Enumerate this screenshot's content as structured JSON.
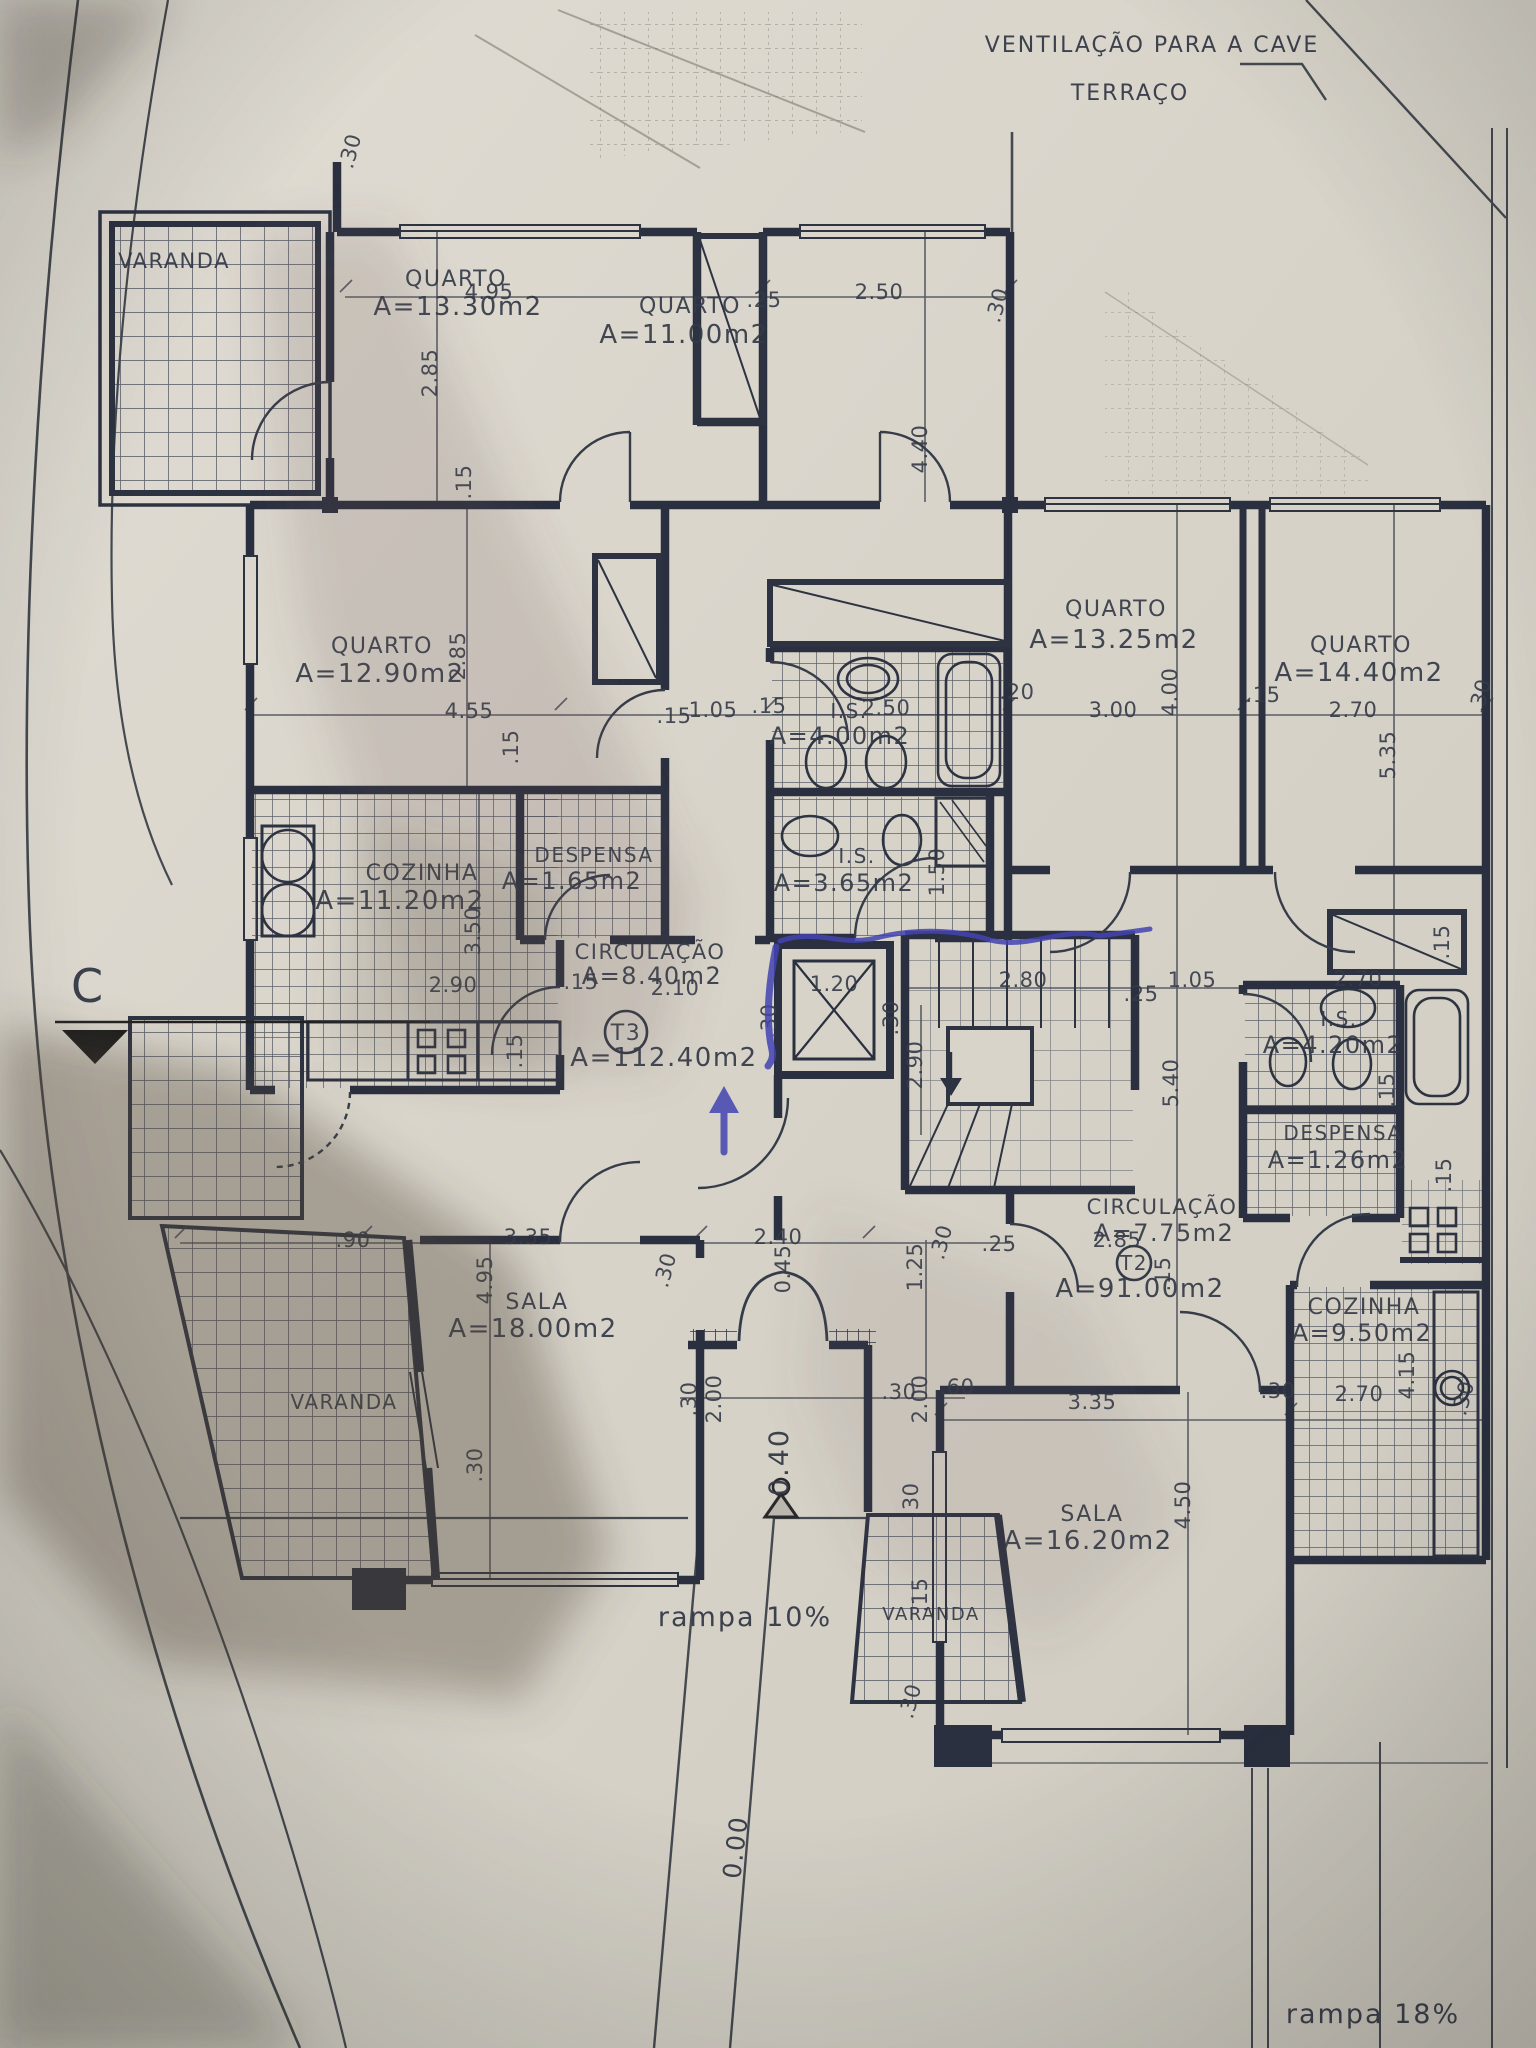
{
  "document_kind": "architectural floor plan photo",
  "colors": {
    "paper": "#d8d4ca",
    "ink": "#2e3342",
    "thin_line": "#454a56",
    "pen_blue": "#4343b2",
    "marker_black": "#1d1d1d"
  },
  "annotations": {
    "site": [
      {
        "name": "label-ventilacao-cave",
        "text": "VENTILAÇÃO PARA A CAVE",
        "x": 1152,
        "y": 52,
        "s": 22
      },
      {
        "name": "label-terraco",
        "text": "TERRAÇO",
        "x": 1130,
        "y": 100,
        "s": 22
      },
      {
        "name": "label-rampa-10",
        "text": "rampa 10%",
        "x": 745,
        "y": 1626,
        "s": 27
      },
      {
        "name": "label-rampa-18",
        "text": "rampa 18%",
        "x": 1373,
        "y": 2023,
        "s": 27
      },
      {
        "name": "level-mark-0-00",
        "text": "0.00",
        "x": 744,
        "y": 1848,
        "r": -83,
        "s": 25
      },
      {
        "name": "level-mark-0-40",
        "text": "0.40",
        "x": 788,
        "y": 1462,
        "r": -90,
        "s": 27
      },
      {
        "name": "section-marker-c",
        "text": "C",
        "x": 88,
        "y": 1002,
        "s": 46
      }
    ],
    "rooms": [
      {
        "name": "room-varanda-topleft",
        "text": "VARANDA",
        "x": 174,
        "y": 268,
        "s": 21
      },
      {
        "name": "room-quarto1",
        "text": "QUARTO",
        "x": 456,
        "y": 286,
        "s": 22
      },
      {
        "name": "room-quarto1-area",
        "text": "A=13.30m2",
        "x": 458,
        "y": 315,
        "s": 26
      },
      {
        "name": "room-quarto2",
        "text": "QUARTO",
        "x": 690,
        "y": 313,
        "s": 22
      },
      {
        "name": "room-quarto2-area",
        "text": "A=11.00m2",
        "x": 684,
        "y": 343,
        "s": 26
      },
      {
        "name": "room-quarto3",
        "text": "QUARTO",
        "x": 382,
        "y": 653,
        "s": 22
      },
      {
        "name": "room-quarto3-area",
        "text": "A=12.90m2",
        "x": 380,
        "y": 682,
        "s": 26
      },
      {
        "name": "room-cozinha-t3",
        "text": "COZINHA",
        "x": 422,
        "y": 880,
        "s": 22
      },
      {
        "name": "room-cozinha-t3-area",
        "text": "A=11.20m2",
        "x": 400,
        "y": 909,
        "s": 26
      },
      {
        "name": "room-despensa-t3",
        "text": "DESPENSA",
        "x": 594,
        "y": 862,
        "s": 20
      },
      {
        "name": "room-despensa-t3-area",
        "text": "A=1.65m2",
        "x": 572,
        "y": 889,
        "s": 24
      },
      {
        "name": "room-circulacao-t3",
        "text": "CIRCULAÇÃO",
        "x": 650,
        "y": 959,
        "s": 21
      },
      {
        "name": "room-circulacao-t3-area",
        "text": "A=8.40m2",
        "x": 652,
        "y": 984,
        "s": 24
      },
      {
        "name": "unit-t3",
        "text": "T3",
        "x": 626,
        "y": 1040,
        "s": 22
      },
      {
        "name": "unit-t3-area",
        "text": "A=112.40m2",
        "x": 664,
        "y": 1066,
        "s": 26
      },
      {
        "name": "room-is-400",
        "text": "I.S.",
        "x": 849,
        "y": 718,
        "s": 20
      },
      {
        "name": "room-is-400-area",
        "text": "A=4.00m2",
        "x": 840,
        "y": 744,
        "s": 24
      },
      {
        "name": "room-is-365",
        "text": "I.S.",
        "x": 857,
        "y": 863,
        "s": 20
      },
      {
        "name": "room-is-365-area",
        "text": "A=3.65m2",
        "x": 844,
        "y": 891,
        "s": 24
      },
      {
        "name": "room-sala-t3",
        "text": "SALA",
        "x": 537,
        "y": 1309,
        "s": 22
      },
      {
        "name": "room-sala-t3-area",
        "text": "A=18.00m2",
        "x": 533,
        "y": 1337,
        "s": 26
      },
      {
        "name": "room-varanda-left",
        "text": "VARANDA",
        "x": 344,
        "y": 1409,
        "s": 20
      },
      {
        "name": "room-quarto4",
        "text": "QUARTO",
        "x": 1116,
        "y": 616,
        "s": 22
      },
      {
        "name": "room-quarto4-area",
        "text": "A=13.25m2",
        "x": 1114,
        "y": 648,
        "s": 26
      },
      {
        "name": "room-quarto5",
        "text": "QUARTO",
        "x": 1361,
        "y": 652,
        "s": 22
      },
      {
        "name": "room-quarto5-area",
        "text": "A=14.40m2",
        "x": 1359,
        "y": 681,
        "s": 26
      },
      {
        "name": "room-is-420",
        "text": "I.S.",
        "x": 1339,
        "y": 1026,
        "s": 20
      },
      {
        "name": "room-is-420-area",
        "text": "A=4.20m2",
        "x": 1333,
        "y": 1053,
        "s": 24
      },
      {
        "name": "room-despensa-t2",
        "text": "DESPENSA",
        "x": 1343,
        "y": 1140,
        "s": 20
      },
      {
        "name": "room-despensa-t2-area",
        "text": "A=1.26m2",
        "x": 1338,
        "y": 1168,
        "s": 24
      },
      {
        "name": "room-circulacao-t2",
        "text": "CIRCULAÇÃO",
        "x": 1162,
        "y": 1214,
        "s": 21
      },
      {
        "name": "room-circulacao-t2-area",
        "text": "A=7.75m2",
        "x": 1164,
        "y": 1241,
        "s": 24
      },
      {
        "name": "unit-t2",
        "text": "T2",
        "x": 1134,
        "y": 1270,
        "s": 20
      },
      {
        "name": "unit-t2-area",
        "text": "A=91.00m2",
        "x": 1140,
        "y": 1297,
        "s": 26
      },
      {
        "name": "room-cozinha-t2",
        "text": "COZINHA",
        "x": 1364,
        "y": 1314,
        "s": 22
      },
      {
        "name": "room-cozinha-t2-area",
        "text": "A=9.50m2",
        "x": 1362,
        "y": 1341,
        "s": 24
      },
      {
        "name": "room-sala-t2",
        "text": "SALA",
        "x": 1092,
        "y": 1521,
        "s": 22
      },
      {
        "name": "room-sala-t2-area",
        "text": "A=16.20m2",
        "x": 1088,
        "y": 1549,
        "s": 26
      },
      {
        "name": "room-varanda-bottom",
        "text": "VARANDA",
        "x": 931,
        "y": 1620,
        "s": 18
      }
    ],
    "dims": [
      {
        "name": "dim-30-topleft",
        "text": ".30",
        "x": 357,
        "y": 153,
        "r": -75
      },
      {
        "name": "dim-495-top",
        "text": "4.95",
        "x": 489,
        "y": 299
      },
      {
        "name": "dim-285-q1",
        "text": "2.85",
        "x": 437,
        "y": 373,
        "r": -90
      },
      {
        "name": "dim-15-q1",
        "text": ".15",
        "x": 471,
        "y": 482,
        "r": -90
      },
      {
        "name": "dim-25-top",
        "text": ".25",
        "x": 764,
        "y": 307
      },
      {
        "name": "dim-250-top",
        "text": "2.50",
        "x": 879,
        "y": 299
      },
      {
        "name": "dim-30-top2",
        "text": ".30",
        "x": 1004,
        "y": 307,
        "r": -75
      },
      {
        "name": "dim-440-q2",
        "text": "4.40",
        "x": 927,
        "y": 449,
        "r": -90
      },
      {
        "name": "dim-285-q3",
        "text": "2.85",
        "x": 465,
        "y": 656,
        "r": -90
      },
      {
        "name": "dim-455-q3",
        "text": "4.55",
        "x": 469,
        "y": 718
      },
      {
        "name": "dim-15-q3a",
        "text": ".15",
        "x": 518,
        "y": 747,
        "r": -90
      },
      {
        "name": "dim-15-q3b",
        "text": ".15",
        "x": 674,
        "y": 723
      },
      {
        "name": "dim-105-mid",
        "text": "1.05",
        "x": 713,
        "y": 717
      },
      {
        "name": "dim-15-mid",
        "text": ".15",
        "x": 769,
        "y": 713
      },
      {
        "name": "dim-250-is",
        "text": "2.50",
        "x": 886,
        "y": 715
      },
      {
        "name": "dim-20-mid",
        "text": ".20",
        "x": 1017,
        "y": 699
      },
      {
        "name": "dim-300-q4",
        "text": "3.00",
        "x": 1113,
        "y": 717
      },
      {
        "name": "dim-400-q4",
        "text": "4.00",
        "x": 1177,
        "y": 692,
        "r": -90
      },
      {
        "name": "dim-15-q4",
        "text": ".15",
        "x": 1263,
        "y": 702
      },
      {
        "name": "dim-270-q5",
        "text": "2.70",
        "x": 1353,
        "y": 717
      },
      {
        "name": "dim-535-q5",
        "text": "5.35",
        "x": 1395,
        "y": 755,
        "r": -90
      },
      {
        "name": "dim-30-q5",
        "text": ".30",
        "x": 1487,
        "y": 698,
        "r": -75
      },
      {
        "name": "dim-350-coz",
        "text": "3.50",
        "x": 480,
        "y": 931,
        "r": -90
      },
      {
        "name": "dim-290-coz",
        "text": "2.90",
        "x": 453,
        "y": 992
      },
      {
        "name": "dim-15-coz",
        "text": ".15",
        "x": 581,
        "y": 989
      },
      {
        "name": "dim-15-coz2",
        "text": ".15",
        "x": 522,
        "y": 1051,
        "r": -90
      },
      {
        "name": "dim-210-circ",
        "text": "2.10",
        "x": 675,
        "y": 995
      },
      {
        "name": "dim-120-elev",
        "text": "1.20",
        "x": 834,
        "y": 991
      },
      {
        "name": "dim-30-elev-l",
        "text": ".30",
        "x": 776,
        "y": 1021,
        "r": -90
      },
      {
        "name": "dim-30-elev-r",
        "text": ".30",
        "x": 898,
        "y": 1018,
        "r": -90
      },
      {
        "name": "dim-290-hall",
        "text": "2.90",
        "x": 922,
        "y": 1065,
        "r": -90
      },
      {
        "name": "dim-150-is365",
        "text": "1.50",
        "x": 944,
        "y": 872,
        "r": -90
      },
      {
        "name": "dim-280-stairs",
        "text": "2.80",
        "x": 1023,
        "y": 987
      },
      {
        "name": "dim-25-stairs",
        "text": ".25",
        "x": 1141,
        "y": 1001
      },
      {
        "name": "dim-105-stairs",
        "text": "1.05",
        "x": 1192,
        "y": 987
      },
      {
        "name": "dim-540-corr",
        "text": "5.40",
        "x": 1178,
        "y": 1083,
        "r": -90
      },
      {
        "name": "dim-270-is420",
        "text": "2.70",
        "x": 1358,
        "y": 986
      },
      {
        "name": "dim-15-ward",
        "text": ".15",
        "x": 1449,
        "y": 942,
        "r": -90
      },
      {
        "name": "dim-15-is420",
        "text": ".15",
        "x": 1394,
        "y": 1090,
        "r": -90
      },
      {
        "name": "dim-15-desp2",
        "text": ".15",
        "x": 1451,
        "y": 1175,
        "r": -90
      },
      {
        "name": "dim-285-circ2",
        "text": "2.85",
        "x": 1117,
        "y": 1247
      },
      {
        "name": "dim-15-circ2",
        "text": ".15",
        "x": 1170,
        "y": 1274,
        "r": -90
      },
      {
        "name": "dim-415-coz2",
        "text": "4.15",
        "x": 1414,
        "y": 1375,
        "r": -90
      },
      {
        "name": "dim-270-coz2",
        "text": "2.70",
        "x": 1359,
        "y": 1401
      },
      {
        "name": "dim-30-coz2",
        "text": ".30",
        "x": 1278,
        "y": 1398
      },
      {
        "name": "dim-30-coz2b",
        "text": ".30",
        "x": 1470,
        "y": 1400,
        "r": -75
      },
      {
        "name": "dim-240-entr",
        "text": "2.40",
        "x": 778,
        "y": 1244
      },
      {
        "name": "dim-045-entr",
        "text": "0.45",
        "x": 790,
        "y": 1269,
        "r": -90
      },
      {
        "name": "dim-125-entr",
        "text": "1.25",
        "x": 922,
        "y": 1267,
        "r": -90
      },
      {
        "name": "dim-30-entr",
        "text": ".30",
        "x": 948,
        "y": 1244,
        "r": -75
      },
      {
        "name": "dim-25-entr",
        "text": ".25",
        "x": 999,
        "y": 1251
      },
      {
        "name": "dim-90-sala",
        "text": ".90",
        "x": 353,
        "y": 1247
      },
      {
        "name": "dim-335-sala",
        "text": "3.35",
        "x": 528,
        "y": 1244
      },
      {
        "name": "dim-495-sala",
        "text": "4.95",
        "x": 492,
        "y": 1280,
        "r": -90
      },
      {
        "name": "dim-30-sala",
        "text": ".30",
        "x": 482,
        "y": 1465,
        "r": -90
      },
      {
        "name": "dim-30-sala2",
        "text": ".30",
        "x": 672,
        "y": 1272,
        "r": -75
      },
      {
        "name": "dim-30-hall2",
        "text": ".30",
        "x": 696,
        "y": 1399,
        "r": -90
      },
      {
        "name": "dim-200-hall",
        "text": "2.00",
        "x": 721,
        "y": 1399,
        "r": -90
      },
      {
        "name": "dim-30-hall3",
        "text": ".30",
        "x": 899,
        "y": 1399
      },
      {
        "name": "dim-200-hall2",
        "text": "2.00",
        "x": 927,
        "y": 1399,
        "r": -90
      },
      {
        "name": "dim-60-hall",
        "text": ".60",
        "x": 957,
        "y": 1394
      },
      {
        "name": "dim-335-sala2",
        "text": "3.35",
        "x": 1092,
        "y": 1409
      },
      {
        "name": "dim-450-sala2",
        "text": "4.50",
        "x": 1190,
        "y": 1505,
        "r": -90
      },
      {
        "name": "dim-30-var",
        "text": ".30",
        "x": 918,
        "y": 1500,
        "r": -90
      },
      {
        "name": "dim-15-var",
        "text": ".15",
        "x": 927,
        "y": 1595,
        "r": -90
      },
      {
        "name": "dim-30-var2",
        "text": ".30",
        "x": 917,
        "y": 1703,
        "r": -75
      }
    ]
  }
}
